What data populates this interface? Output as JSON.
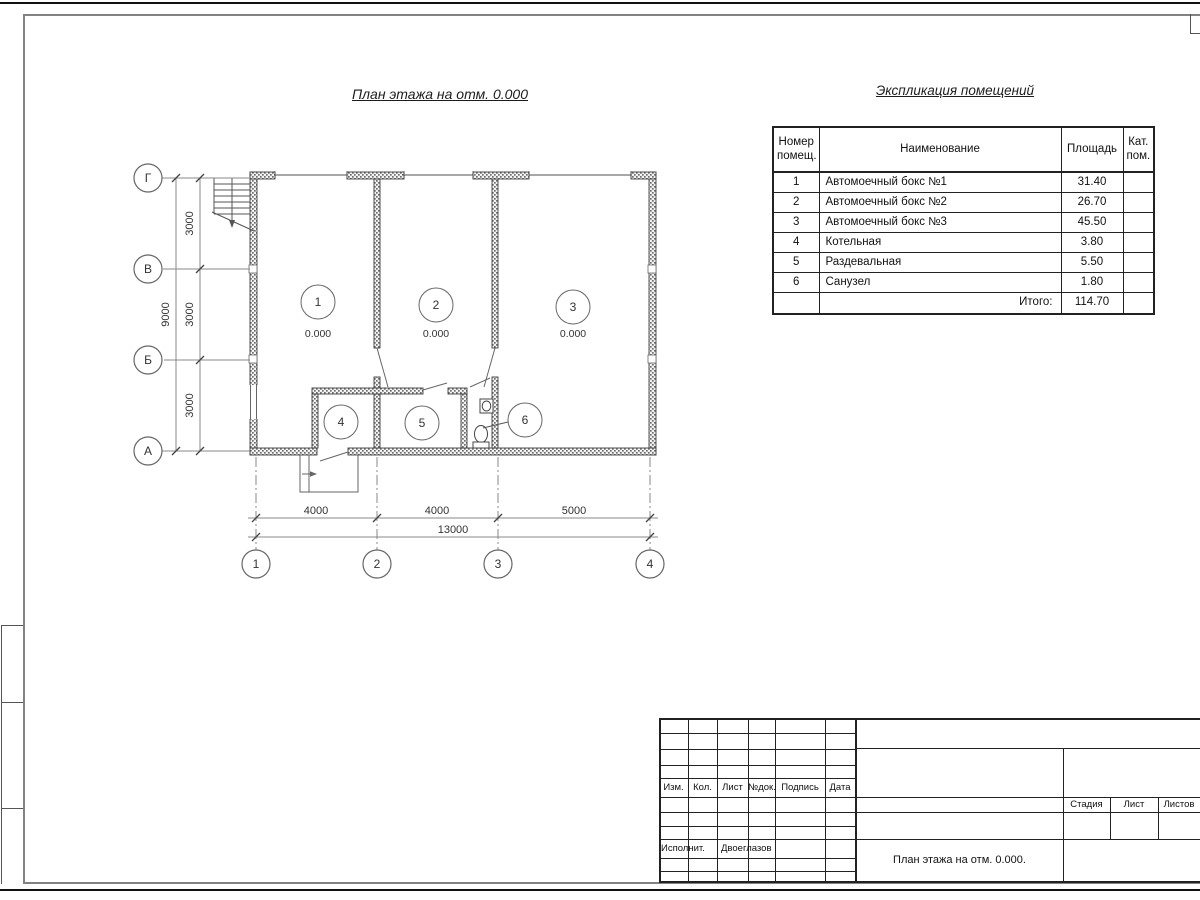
{
  "plan": {
    "title": "План этажа на отм. 0.000",
    "rooms": [
      {
        "num": "1",
        "elev": "0.000"
      },
      {
        "num": "2",
        "elev": "0.000"
      },
      {
        "num": "3",
        "elev": "0.000"
      },
      {
        "num": "4"
      },
      {
        "num": "5"
      },
      {
        "num": "6"
      }
    ],
    "row_axes": [
      "Г",
      "В",
      "Б",
      "А"
    ],
    "col_axes": [
      "1",
      "2",
      "3",
      "4"
    ],
    "v_dims": {
      "s1": "3000",
      "s2": "3000",
      "s3": "3000",
      "total": "9000"
    },
    "h_dims": {
      "s1": "4000",
      "s2": "4000",
      "s3": "5000",
      "total": "13000"
    }
  },
  "explication": {
    "title": "Экспликация помещений",
    "headers": {
      "num": "Номер помещ.",
      "name": "Наименование",
      "area": "Площадь",
      "cat": "Кат. пом."
    },
    "rows": [
      {
        "num": "1",
        "name": "Автомоечный бокс №1",
        "area": "31.40",
        "cat": ""
      },
      {
        "num": "2",
        "name": "Автомоечный бокс №2",
        "area": "26.70",
        "cat": ""
      },
      {
        "num": "3",
        "name": "Автомоечный бокс №3",
        "area": "45.50",
        "cat": ""
      },
      {
        "num": "4",
        "name": "Котельная",
        "area": "3.80",
        "cat": ""
      },
      {
        "num": "5",
        "name": "Раздевальная",
        "area": "5.50",
        "cat": ""
      },
      {
        "num": "6",
        "name": "Санузел",
        "area": "1.80",
        "cat": ""
      }
    ],
    "total": {
      "label": "Итого:",
      "value": "114.70"
    }
  },
  "titleblock": {
    "rev_headers": [
      "Изм.",
      "Кол.",
      "Лист",
      "№док.",
      "Подпись",
      "Дата"
    ],
    "executor": {
      "label": "Исполнит.",
      "name": "Двоеглазов"
    },
    "doc_title": "План этажа на отм. 0.000.",
    "stage": {
      "stage": "Стадия",
      "sheet": "Лист",
      "sheets": "Листов"
    }
  }
}
